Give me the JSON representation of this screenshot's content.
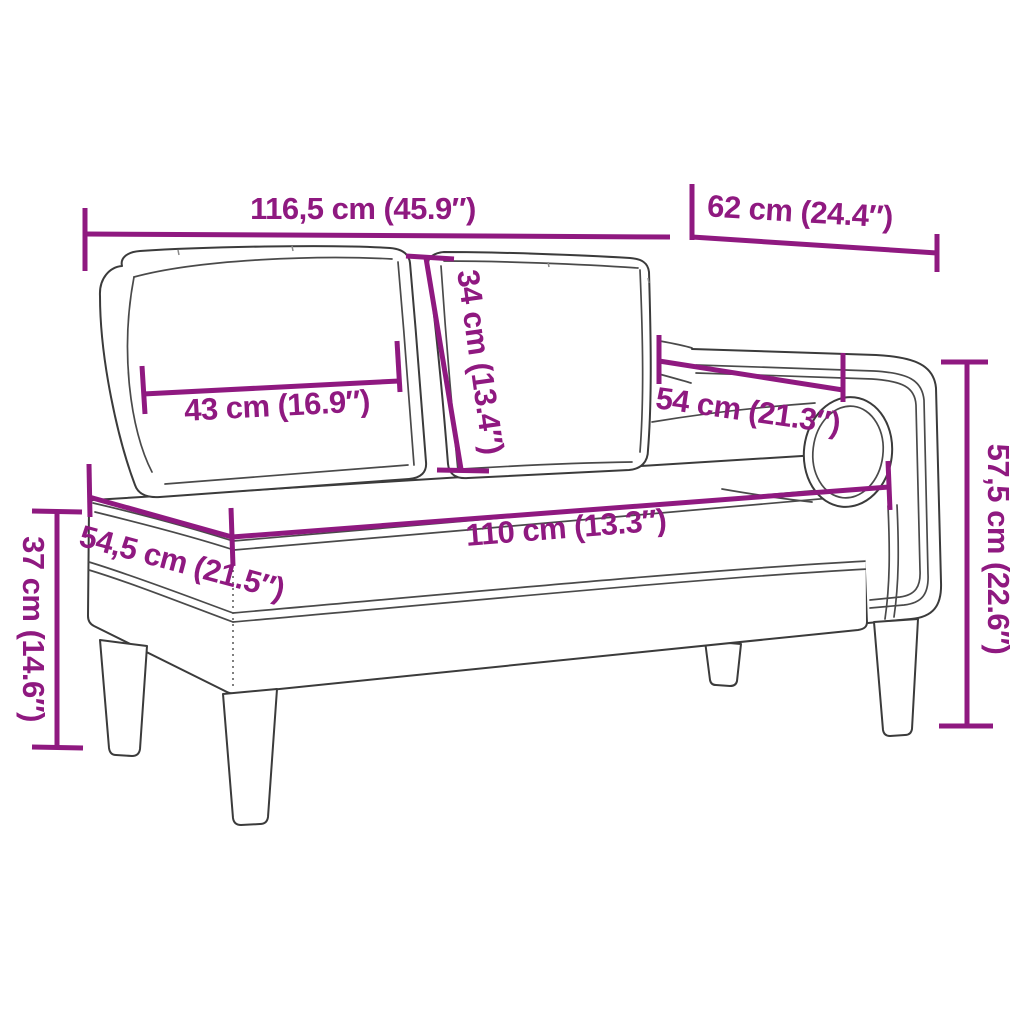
{
  "figure": "chaise-longue-line-drawing",
  "colors": {
    "accent": "#8F1980",
    "outline": "#3B3B3B",
    "background": "#FFFFFF"
  },
  "dimensions": {
    "total_width": {
      "label": "116,5 cm (45.9″)"
    },
    "right_section_width": {
      "label": "62 cm (24.4″)"
    },
    "back_cushion_width": {
      "label": "43 cm (16.9″)"
    },
    "back_cushion_height": {
      "label": "34 cm (13.4″)"
    },
    "armrest_length": {
      "label": "54 cm (21.3″)"
    },
    "total_height": {
      "label": "57,5 cm (22.6″)"
    },
    "seat_height": {
      "label": "37 cm (14.6″)"
    },
    "seat_depth": {
      "label": "54,5 cm (21.5″)"
    },
    "seat_width": {
      "label": "110 cm (13.3″)"
    }
  }
}
